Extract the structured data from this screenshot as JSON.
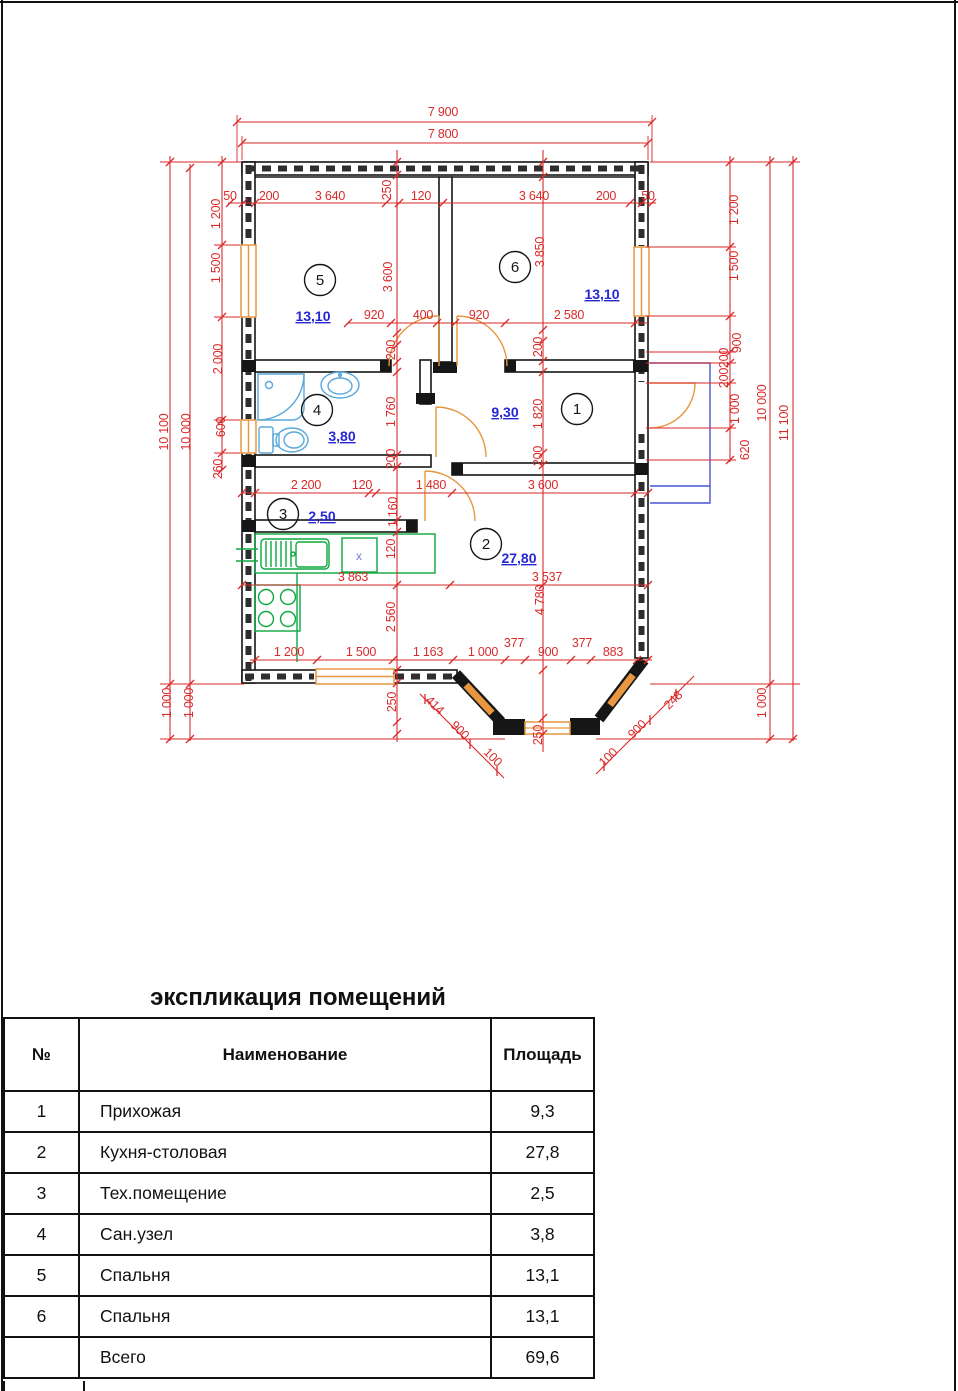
{
  "colors": {
    "dim": "#d92a2a",
    "area": "#2727d3",
    "wall": "#161616",
    "win": "#e8963f",
    "door": "#e8963f",
    "fixblue": "#5aa7dc",
    "fixgreen": "#0ca83e",
    "porch": "#4953d8",
    "xv": "#7b7be0"
  },
  "plan": {
    "labels": [
      {
        "t": "7 900",
        "x": 443,
        "y": 116
      },
      {
        "t": "7 800",
        "x": 443,
        "y": 138
      },
      {
        "t": "50",
        "x": 230,
        "y": 200
      },
      {
        "t": "200",
        "x": 269,
        "y": 200
      },
      {
        "t": "3 640",
        "x": 330,
        "y": 200
      },
      {
        "t": "250",
        "x": 391,
        "y": 190,
        "rot": -90
      },
      {
        "t": "120",
        "x": 421,
        "y": 200
      },
      {
        "t": "3 640",
        "x": 534,
        "y": 200
      },
      {
        "t": "200",
        "x": 606,
        "y": 200
      },
      {
        "t": "50",
        "x": 648,
        "y": 200
      },
      {
        "t": "3 600",
        "x": 392,
        "y": 277,
        "rot": -90
      },
      {
        "t": "3 850",
        "x": 544,
        "y": 252,
        "rot": -90
      },
      {
        "t": "920",
        "x": 374,
        "y": 319
      },
      {
        "t": "400",
        "x": 423,
        "y": 319
      },
      {
        "t": "920",
        "x": 479,
        "y": 319
      },
      {
        "t": "2 580",
        "x": 569,
        "y": 319
      },
      {
        "t": "200",
        "x": 395,
        "y": 350,
        "rot": -90
      },
      {
        "t": "1 760",
        "x": 395,
        "y": 412,
        "rot": -90
      },
      {
        "t": "200",
        "x": 395,
        "y": 459,
        "rot": -90
      },
      {
        "t": "200",
        "x": 542,
        "y": 347,
        "rot": -90
      },
      {
        "t": "1 820",
        "x": 542,
        "y": 414,
        "rot": -90
      },
      {
        "t": "200",
        "x": 542,
        "y": 456,
        "rot": -90
      },
      {
        "t": "2 200",
        "x": 306,
        "y": 489
      },
      {
        "t": "120",
        "x": 362,
        "y": 489
      },
      {
        "t": "1 480",
        "x": 431,
        "y": 489
      },
      {
        "t": "3 600",
        "x": 543,
        "y": 489
      },
      {
        "t": "1 160",
        "x": 397,
        "y": 512,
        "rot": -90
      },
      {
        "t": "120",
        "x": 395,
        "y": 549,
        "rot": -90
      },
      {
        "t": "3 863",
        "x": 353,
        "y": 581
      },
      {
        "t": "3 537",
        "x": 547,
        "y": 581
      },
      {
        "t": "4 780",
        "x": 544,
        "y": 600,
        "rot": -90
      },
      {
        "t": "2 560",
        "x": 395,
        "y": 617,
        "rot": -90
      },
      {
        "t": "1 200",
        "x": 289,
        "y": 656
      },
      {
        "t": "1 500",
        "x": 361,
        "y": 656
      },
      {
        "t": "1 163",
        "x": 428,
        "y": 656
      },
      {
        "t": "1 000",
        "x": 483,
        "y": 656
      },
      {
        "t": "377",
        "x": 514,
        "y": 647
      },
      {
        "t": "900",
        "x": 548,
        "y": 656
      },
      {
        "t": "377",
        "x": 582,
        "y": 647
      },
      {
        "t": "883",
        "x": 613,
        "y": 656
      },
      {
        "t": "250",
        "x": 396,
        "y": 702,
        "rot": -90
      },
      {
        "t": "250",
        "x": 542,
        "y": 735,
        "rot": -90
      },
      {
        "t": "414",
        "x": 432,
        "y": 708,
        "rot": 45
      },
      {
        "t": "900",
        "x": 457,
        "y": 733,
        "rot": 45
      },
      {
        "t": "100",
        "x": 490,
        "y": 760,
        "rot": 45
      },
      {
        "t": "100",
        "x": 611,
        "y": 760,
        "rot": -45
      },
      {
        "t": "900",
        "x": 640,
        "y": 732,
        "rot": -45
      },
      {
        "t": "248",
        "x": 676,
        "y": 703,
        "rot": -45
      },
      {
        "t": "10 100",
        "x": 168,
        "y": 432,
        "rot": -90
      },
      {
        "t": "10 000",
        "x": 190,
        "y": 432,
        "rot": -90
      },
      {
        "t": "1 200",
        "x": 220,
        "y": 214,
        "rot": -90
      },
      {
        "t": "1 500",
        "x": 220,
        "y": 268,
        "rot": -90
      },
      {
        "t": "2 000",
        "x": 222,
        "y": 359,
        "rot": -90
      },
      {
        "t": "600",
        "x": 225,
        "y": 427,
        "rot": -90
      },
      {
        "t": "260",
        "x": 222,
        "y": 469,
        "rot": -90
      },
      {
        "t": "1 000",
        "x": 171,
        "y": 703,
        "rot": -90
      },
      {
        "t": "1 000",
        "x": 193,
        "y": 703,
        "rot": -90
      },
      {
        "t": "1 200",
        "x": 738,
        "y": 210,
        "rot": -90
      },
      {
        "t": "1 500",
        "x": 738,
        "y": 266,
        "rot": -90
      },
      {
        "t": "900",
        "x": 741,
        "y": 343,
        "rot": -90
      },
      {
        "t": "200",
        "x": 728,
        "y": 358,
        "rot": -90
      },
      {
        "t": "200",
        "x": 728,
        "y": 378,
        "rot": -90
      },
      {
        "t": "1 000",
        "x": 739,
        "y": 409,
        "rot": -90
      },
      {
        "t": "620",
        "x": 749,
        "y": 450,
        "rot": -90
      },
      {
        "t": "10 000",
        "x": 766,
        "y": 403,
        "rot": -90
      },
      {
        "t": "11 100",
        "x": 788,
        "y": 423,
        "rot": -90
      },
      {
        "t": "1 000",
        "x": 766,
        "y": 703,
        "rot": -90
      },
      {
        "t": "5",
        "x": 320,
        "y": 285,
        "kind": "room"
      },
      {
        "t": "6",
        "x": 515,
        "y": 272,
        "kind": "room"
      },
      {
        "t": "4",
        "x": 317,
        "y": 415,
        "kind": "room"
      },
      {
        "t": "1",
        "x": 577,
        "y": 414,
        "kind": "room"
      },
      {
        "t": "3",
        "x": 283,
        "y": 519,
        "kind": "room"
      },
      {
        "t": "2",
        "x": 486,
        "y": 549,
        "kind": "room"
      },
      {
        "t": "13,10",
        "x": 313,
        "y": 321,
        "kind": "area"
      },
      {
        "t": "13,10",
        "x": 602,
        "y": 299,
        "kind": "area"
      },
      {
        "t": "9,30",
        "x": 505,
        "y": 417,
        "kind": "area"
      },
      {
        "t": "3,80",
        "x": 342,
        "y": 441,
        "kind": "area"
      },
      {
        "t": "2,50",
        "x": 322,
        "y": 521,
        "kind": "area"
      },
      {
        "t": "27,80",
        "x": 519,
        "y": 563,
        "kind": "area"
      },
      {
        "t": "x",
        "x": 359,
        "y": 560,
        "kind": "x"
      }
    ],
    "room_circles": [
      {
        "cx": 320,
        "cy": 280
      },
      {
        "cx": 515,
        "cy": 267
      },
      {
        "cx": 317,
        "cy": 410
      },
      {
        "cx": 577,
        "cy": 409
      },
      {
        "cx": 283,
        "cy": 514
      },
      {
        "cx": 486,
        "cy": 544
      }
    ]
  },
  "table": {
    "title": "экспликация помещений",
    "headers": {
      "num": "№",
      "name": "Наименование",
      "area": "Площадь"
    },
    "rows": [
      {
        "num": "1",
        "name": "Прихожая",
        "area": "9,3"
      },
      {
        "num": "2",
        "name": "Кухня-столовая",
        "area": "27,8"
      },
      {
        "num": "3",
        "name": "Тех.помещение",
        "area": "2,5"
      },
      {
        "num": "4",
        "name": "Сан.узел",
        "area": "3,8"
      },
      {
        "num": "5",
        "name": "Спальня",
        "area": "13,1"
      },
      {
        "num": "6",
        "name": "Спальня",
        "area": "13,1"
      },
      {
        "num": "",
        "name": "Всего",
        "area": "69,6"
      }
    ]
  }
}
